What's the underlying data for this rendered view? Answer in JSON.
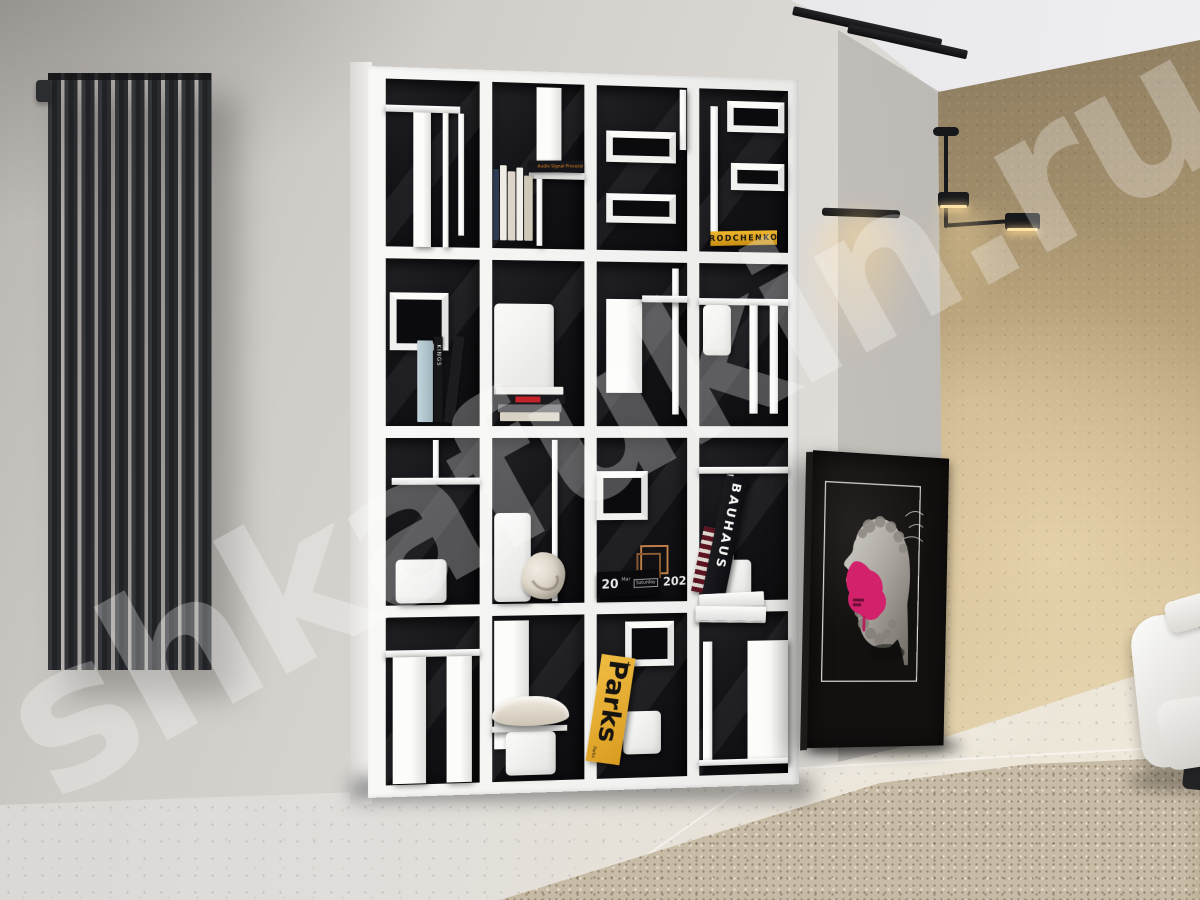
{
  "watermark": {
    "text": "shkafukin.ru"
  },
  "shelf": {
    "books": {
      "rodchenko": {
        "title": "RODCHENKO",
        "spine_color": "#e0a524",
        "text_color": "#181610"
      },
      "bauhaus": {
        "title": "BAUHAUS",
        "spine_color": "#141318",
        "text_color": "#f7f7f5"
      },
      "parks": {
        "title": "Parks",
        "corner_mark": "+",
        "back_label": "Parks",
        "cover_color": "#e9b335",
        "text_color": "#161410"
      },
      "kings": {
        "title": "KINGS",
        "text_color": "#efefef"
      },
      "audio": {
        "title": "Audio Signal Processing and Coding",
        "text_color": "#e8891f"
      }
    },
    "calendar": {
      "day": "20",
      "month": "Mar",
      "weekday": "Saturday",
      "year": "2021"
    }
  },
  "palette": {
    "accent_pink": "#d2226b",
    "accent_copper": "#b87a42",
    "wall_warm": "#c9b187",
    "wall_gray": "#d6d3cf",
    "shelf_white": "#f2f2f0",
    "cell_black": "#141418"
  }
}
